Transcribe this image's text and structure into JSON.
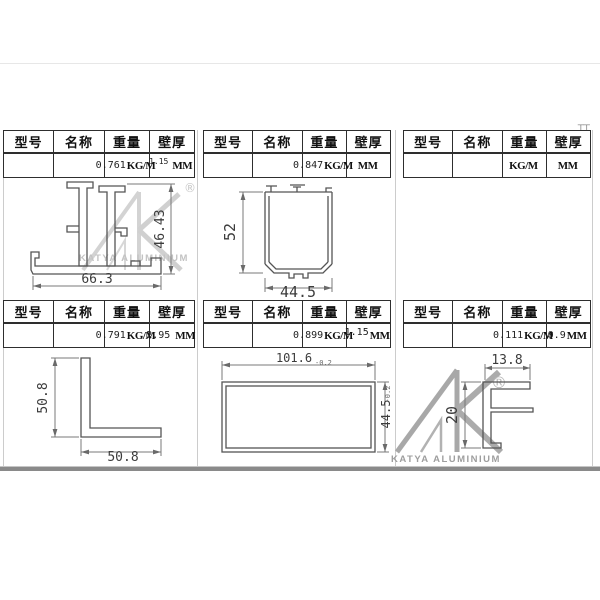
{
  "brand": {
    "name": "KATYA ALUMINIUM",
    "registered": "®"
  },
  "table": {
    "headers": [
      "型号",
      "名称",
      "重量",
      "壁厚"
    ]
  },
  "marks": {
    "corner_glyph": "田",
    "top_right_remnant": "⊤⊤"
  },
  "panels": [
    {
      "name": "top-left",
      "weight": "0.761",
      "weight_unit": "KG/M",
      "thickness": "1.15",
      "thickness_unit": "MM",
      "dims": {
        "bottom": "66.3",
        "side": "46.43"
      }
    },
    {
      "name": "top-middle",
      "weight": "0.847",
      "weight_unit": "KG/M",
      "thickness": "",
      "thickness_unit": "MM",
      "dims": {
        "bottom": "44.5",
        "side": "52"
      }
    },
    {
      "name": "top-right",
      "weight": "",
      "weight_unit": "KG/M",
      "thickness": "",
      "thickness_unit": "MM",
      "dims": {}
    },
    {
      "name": "bottom-left",
      "weight": "0.791",
      "weight_unit": "KG/M",
      "thickness": "2.95",
      "thickness_unit": "MM",
      "dims": {
        "bottom": "50.8",
        "side": "50.8"
      }
    },
    {
      "name": "bottom-middle",
      "weight": "0.899",
      "weight_unit": "KG/M",
      "thickness": "1.15",
      "thickness_unit": "MM",
      "dims": {
        "top": "101.6",
        "top_tol": "-0.2",
        "side": "44.5",
        "side_tol": "-0.2"
      }
    },
    {
      "name": "bottom-right",
      "weight": "0.111",
      "weight_unit": "KG/M",
      "thickness": "0.9",
      "thickness_unit": "MM",
      "dims": {
        "top": "13.8",
        "side": "20"
      }
    }
  ]
}
